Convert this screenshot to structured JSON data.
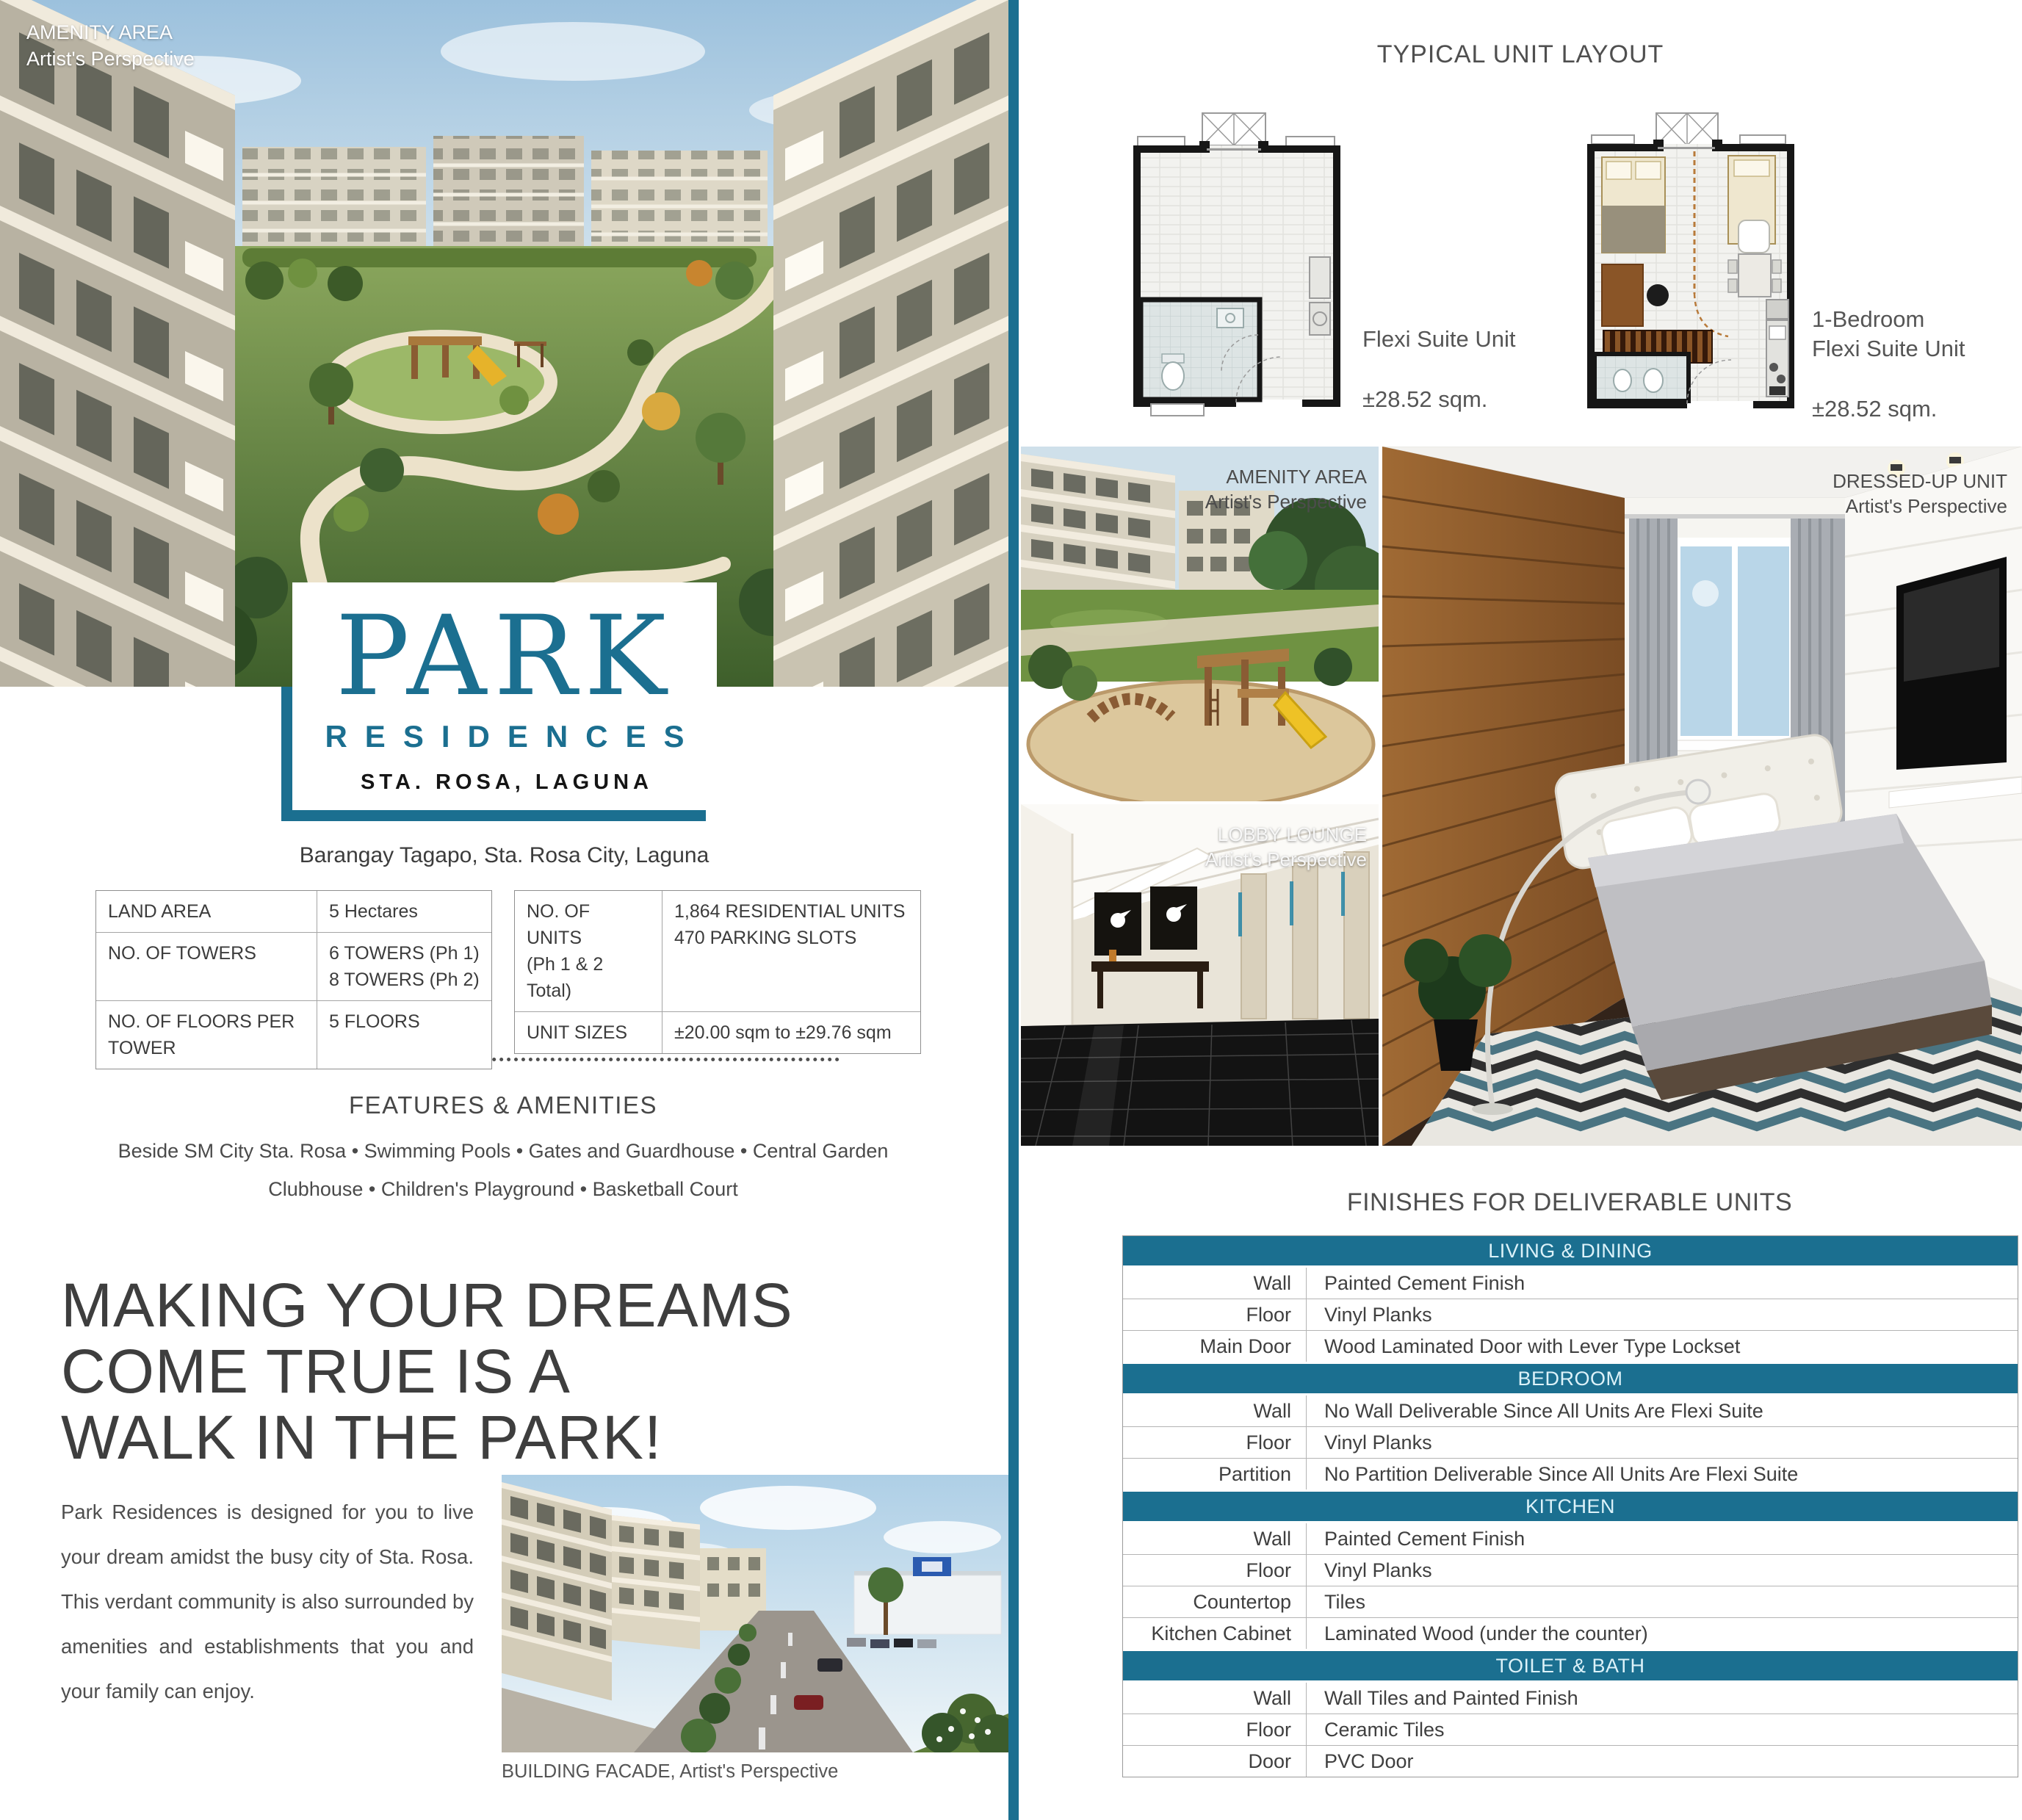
{
  "colors": {
    "accent": "#1b6f90"
  },
  "hero": {
    "label_title": "AMENITY AREA",
    "label_sub": "Artist's Perspective"
  },
  "logo": {
    "name": "PARK",
    "sub": "RESIDENCES",
    "location": "STA. ROSA, LAGUNA"
  },
  "address": "Barangay Tagapo, Sta. Rosa City, Laguna",
  "spec_left": {
    "r1k": "LAND AREA",
    "r1v": "5 Hectares",
    "r2k": "NO. OF TOWERS",
    "r2v1": "6 TOWERS (Ph 1)",
    "r2v2": "8 TOWERS (Ph 2)",
    "r3k": "NO. OF FLOORS PER TOWER",
    "r3v": "5 FLOORS"
  },
  "spec_right": {
    "r1k1": "NO. OF UNITS",
    "r1k2": "(Ph 1 & 2 Total)",
    "r1v1": "1,864 RESIDENTIAL UNITS",
    "r1v2": "470 PARKING SLOTS",
    "r2k": "UNIT SIZES",
    "r2v": "±20.00 sqm to ±29.76 sqm"
  },
  "features": {
    "heading": "FEATURES & AMENITIES",
    "line1": "Beside SM City Sta. Rosa • Swimming Pools • Gates and Guardhouse • Central Garden",
    "line2": "Clubhouse • Children's Playground • Basketball Court"
  },
  "headline": {
    "line1": "MAKING YOUR DREAMS",
    "line2": "COME TRUE IS A",
    "line3": "WALK IN THE PARK!"
  },
  "body_text": "Park Residences is designed for you to live your dream amidst the busy city of Sta. Rosa. This verdant community is also surrounded by amenities and establishments that you and your family can enjoy.",
  "facade_caption": "BUILDING FACADE, Artist's Perspective",
  "unit_layout": {
    "heading": "TYPICAL UNIT LAYOUT",
    "plan1": {
      "name": "Flexi Suite Unit",
      "size": "±28.52 sqm."
    },
    "plan2": {
      "name1": "1-Bedroom",
      "name2": "Flexi Suite Unit",
      "size": "±28.52 sqm."
    }
  },
  "photos": {
    "amenity": {
      "title": "AMENITY AREA",
      "sub": "Artist's Perspective"
    },
    "lobby": {
      "title": "LOBBY LOUNGE",
      "sub": "Artist's Perspective"
    },
    "dressed": {
      "title": "DRESSED-UP UNIT",
      "sub": "Artist's Perspective"
    }
  },
  "finishes": {
    "heading": "FINISHES FOR DELIVERABLE UNITS",
    "sections": [
      {
        "title": "LIVING & DINING",
        "rows": [
          {
            "k": "Wall",
            "v": "Painted Cement Finish"
          },
          {
            "k": "Floor",
            "v": "Vinyl Planks"
          },
          {
            "k": "Main Door",
            "v": "Wood Laminated Door with Lever Type Lockset"
          }
        ]
      },
      {
        "title": "BEDROOM",
        "rows": [
          {
            "k": "Wall",
            "v": "No Wall Deliverable Since All Units Are Flexi Suite"
          },
          {
            "k": "Floor",
            "v": "Vinyl Planks"
          },
          {
            "k": "Partition",
            "v": "No Partition Deliverable Since All Units Are Flexi Suite"
          }
        ]
      },
      {
        "title": "KITCHEN",
        "rows": [
          {
            "k": "Wall",
            "v": "Painted Cement Finish"
          },
          {
            "k": "Floor",
            "v": "Vinyl Planks"
          },
          {
            "k": "Countertop",
            "v": "Tiles"
          },
          {
            "k": "Kitchen Cabinet",
            "v": "Laminated Wood (under the counter)"
          }
        ]
      },
      {
        "title": "TOILET & BATH",
        "rows": [
          {
            "k": "Wall",
            "v": "Wall Tiles and Painted Finish"
          },
          {
            "k": "Floor",
            "v": "Ceramic Tiles"
          },
          {
            "k": "Door",
            "v": "PVC Door"
          }
        ]
      }
    ]
  }
}
